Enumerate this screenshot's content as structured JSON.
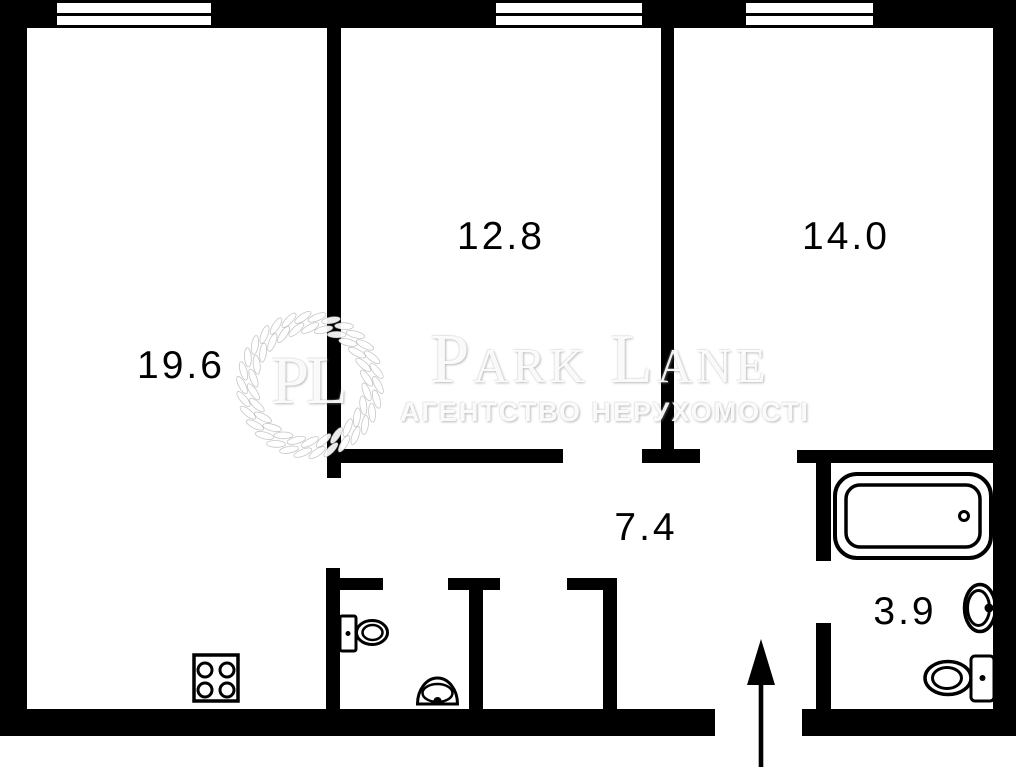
{
  "rooms": [
    {
      "key": "living-room",
      "area": "19.6"
    },
    {
      "key": "bedroom",
      "area": "12.8"
    },
    {
      "key": "bedroom-2",
      "area": "14.0"
    },
    {
      "key": "hallway",
      "area": "7.4"
    },
    {
      "key": "bathroom",
      "area": "3.9"
    }
  ],
  "watermark": {
    "monogram": "PL",
    "brand": "Park Lane",
    "tagline": "АГЕНТСТВО НЕРУХОМОСТІ"
  },
  "fixtures": [
    "window",
    "window",
    "window",
    "stove",
    "toilet",
    "wash-basin",
    "bathtub",
    "wash-basin",
    "toilet",
    "entrance-arrow"
  ],
  "colors": {
    "wall": "#000000",
    "floor": "#ffffff",
    "watermark": "#f0f0f0"
  }
}
